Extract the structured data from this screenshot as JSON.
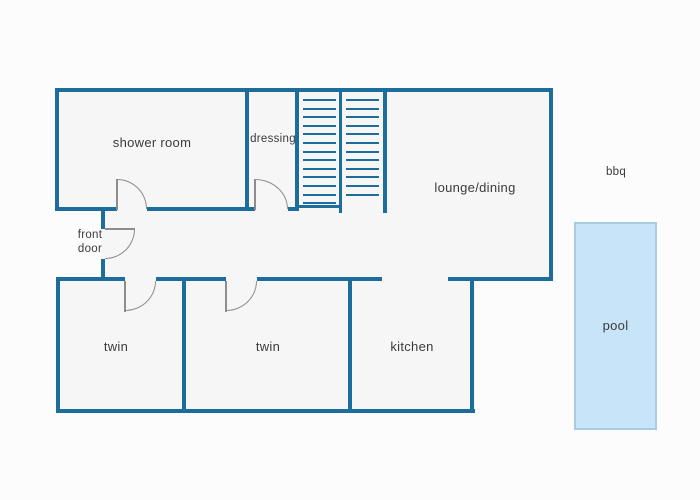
{
  "title": "holiday house floor plan",
  "colors": {
    "bg": "#fcfcfc",
    "wall": "#1c6d9b",
    "floor": "#f5f6f5",
    "door": "#8d8d8d",
    "pool_fill": "#c7e4f8",
    "pool_border": "#a6cbe2",
    "text": "#3b3b3b"
  },
  "rooms": {
    "shower_room": {
      "label": "shower room"
    },
    "dressing": {
      "label": "dressing"
    },
    "lounge_dining": {
      "label": "lounge/dining"
    },
    "front_door": {
      "label": "front\ndoor"
    },
    "twin_left": {
      "label": "twin"
    },
    "twin_middle": {
      "label": "twin"
    },
    "kitchen": {
      "label": "kitchen"
    }
  },
  "outdoor": {
    "bbq": {
      "label": "bbq"
    },
    "pool": {
      "label": "pool"
    }
  },
  "stairs": {
    "flights": [
      {
        "treads": 13,
        "left": 303,
        "top": 99,
        "width": 33,
        "step": 8.6
      },
      {
        "treads": 12,
        "left": 346,
        "top": 99,
        "width": 33,
        "step": 8.6
      }
    ]
  }
}
